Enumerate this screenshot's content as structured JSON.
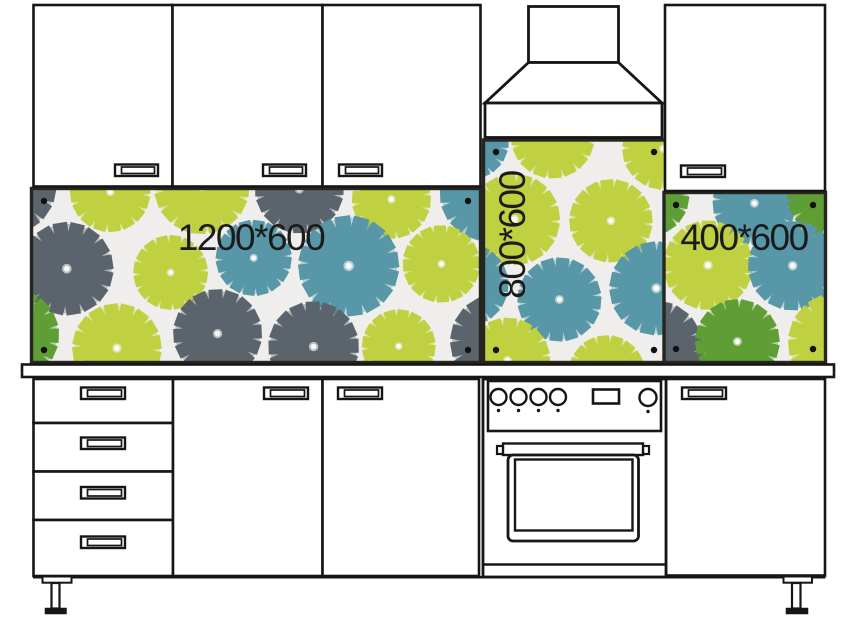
{
  "title": "Kitchen backsplash panel sizes diagram",
  "panels": {
    "left": {
      "label": "1200*600",
      "orientation": "horizontal"
    },
    "middle": {
      "label": "800*600",
      "orientation": "vertical"
    },
    "right": {
      "label": "400*600",
      "orientation": "horizontal"
    }
  },
  "colors": {
    "line": "#161616",
    "label_text": "#1b1b1b",
    "panel_background": "#efeeec",
    "panel_frame": "#26261f",
    "screw": "#111111",
    "flower_teal": "#5897a7",
    "flower_lime": "#bfd040",
    "flower_gray": "#5b646c",
    "flower_green": "#5f9d35"
  }
}
